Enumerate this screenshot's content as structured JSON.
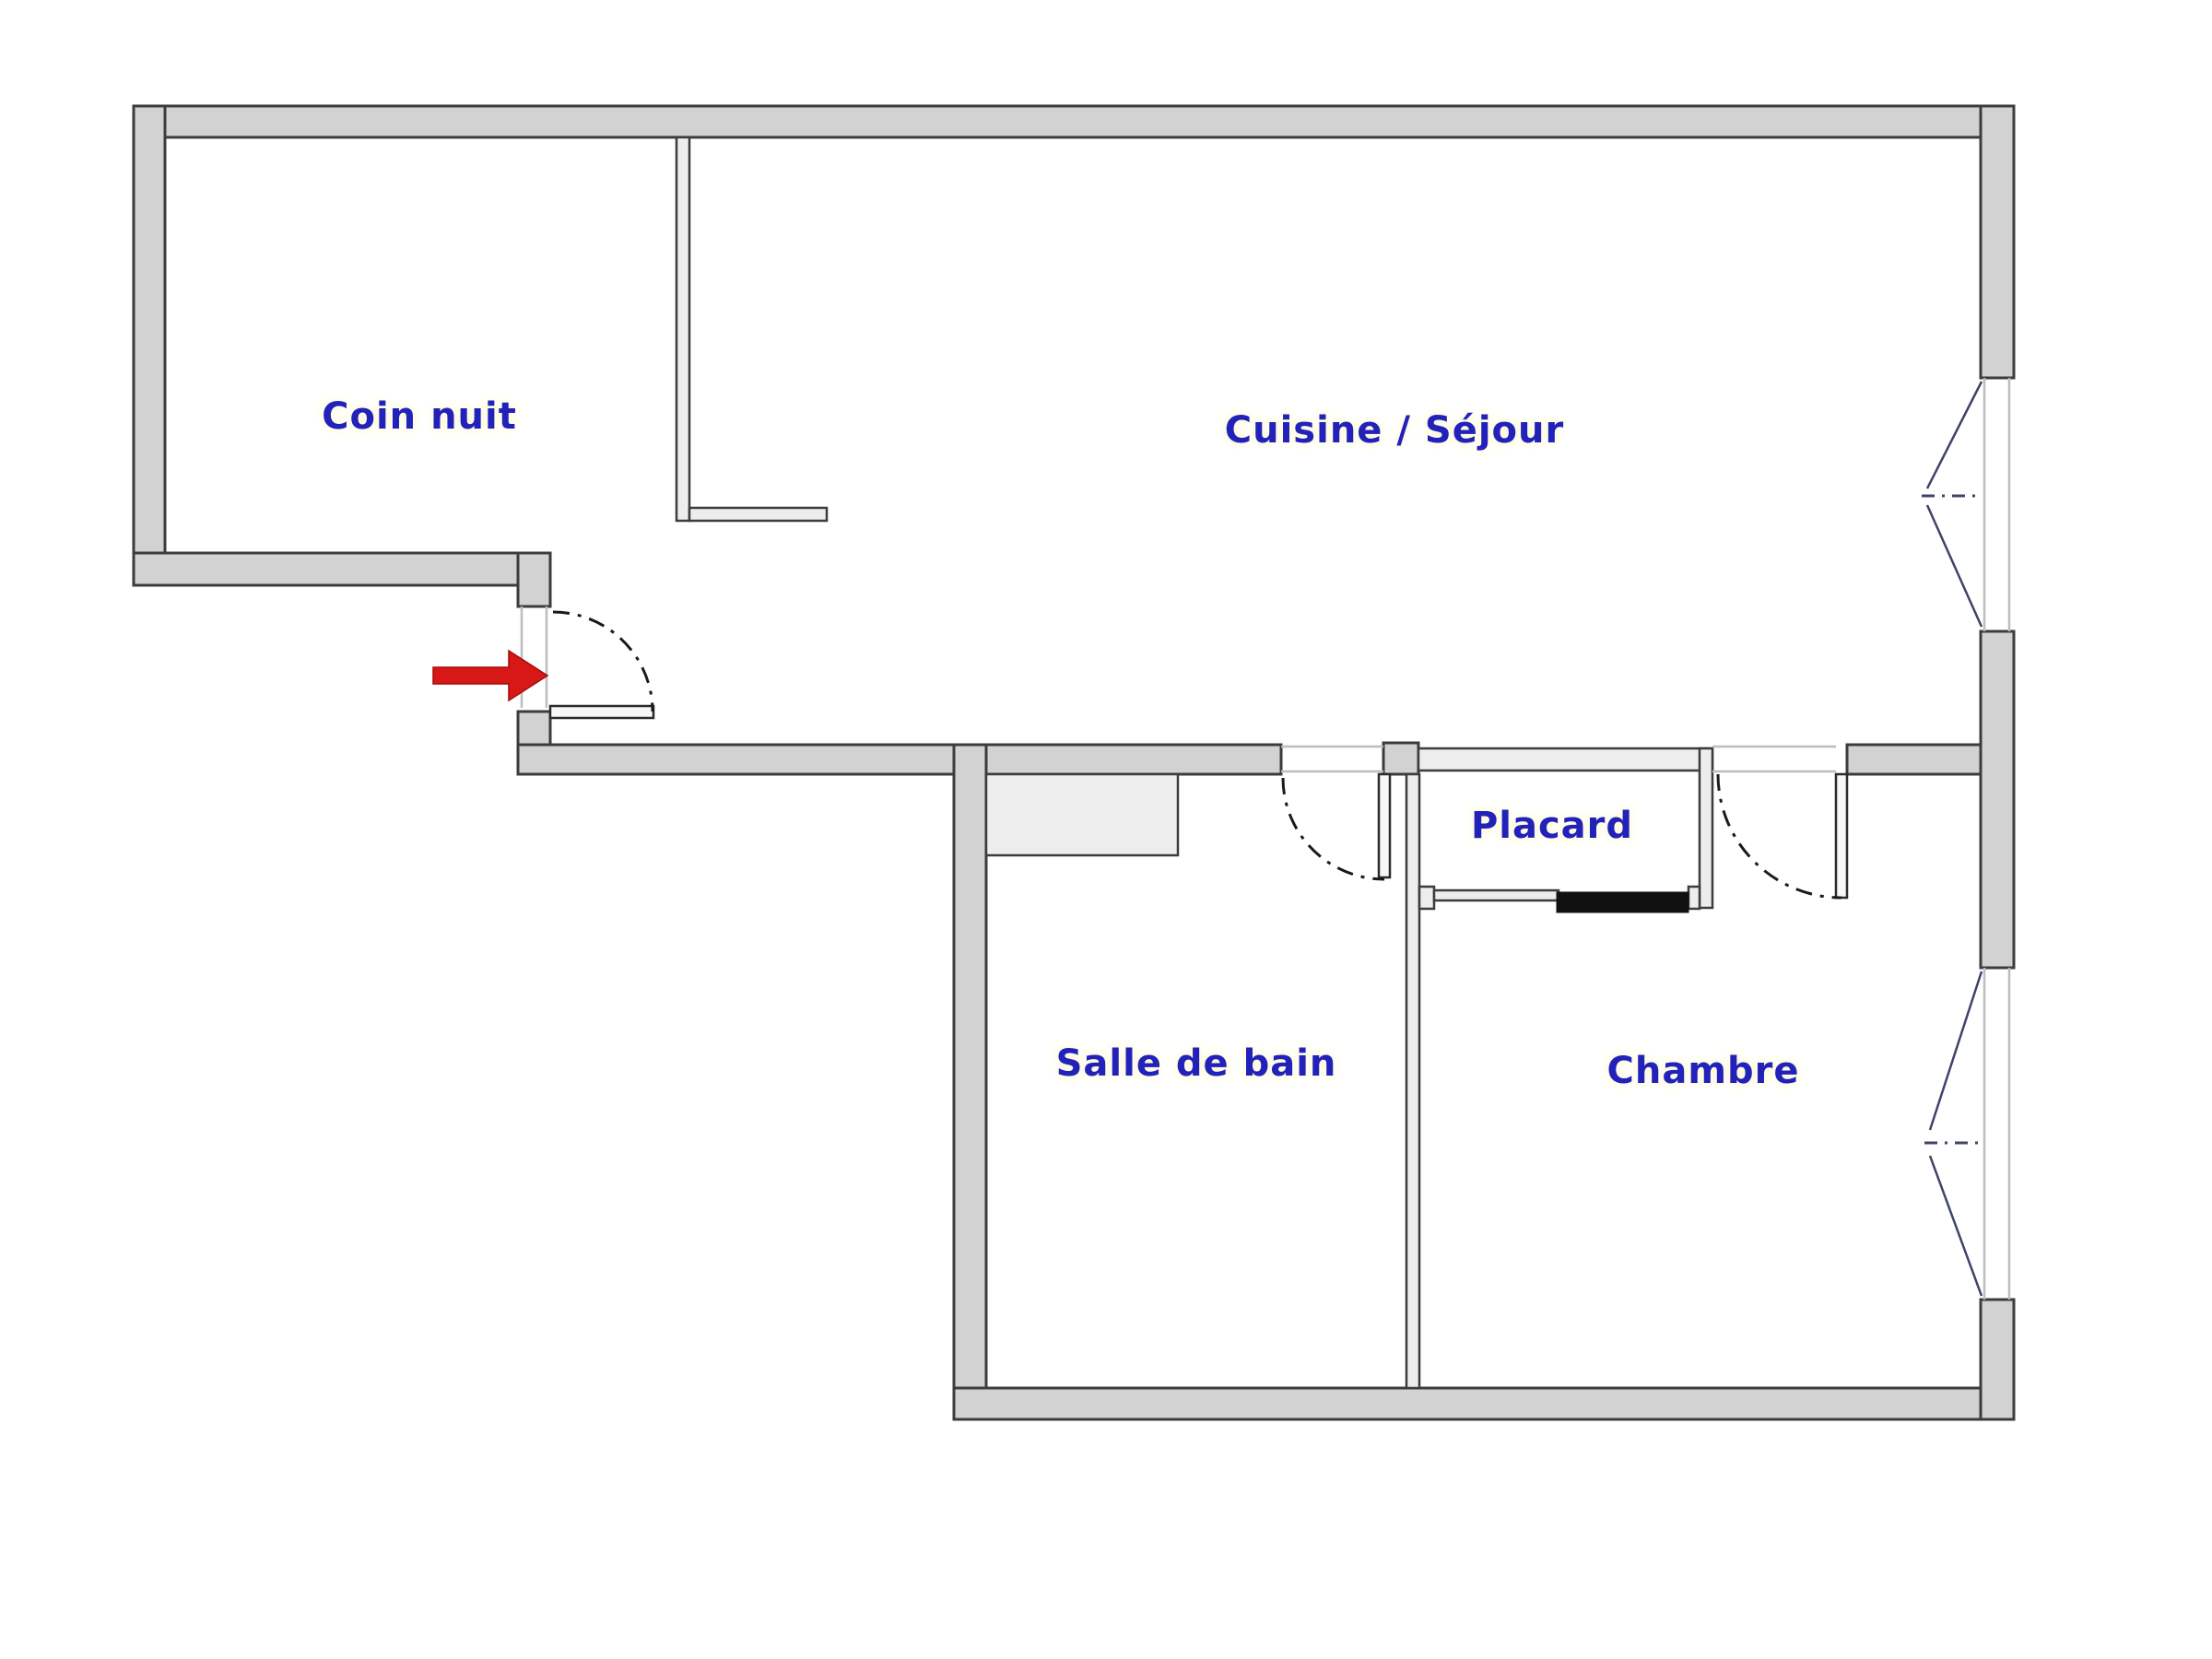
{
  "floor_plan": {
    "type": "apartment-floor-plan",
    "rooms": [
      {
        "id": "coin-nuit",
        "label": "Coin nuit"
      },
      {
        "id": "cuisine-sejour",
        "label": "Cuisine / Séjour"
      },
      {
        "id": "placard",
        "label": "Placard"
      },
      {
        "id": "salle-de-bain",
        "label": "Salle de bain"
      },
      {
        "id": "chambre",
        "label": "Chambre"
      }
    ],
    "features": {
      "entrance_arrow": "red arrow pointing right at entrance door",
      "doors": [
        "entrance swing door",
        "salle-de-bain swing door",
        "chambre swing door",
        "placard sliding door"
      ],
      "windows": [
        "right wall upper casement window",
        "right wall lower casement window"
      ]
    },
    "colors": {
      "wall_fill": "#d2d2d2",
      "wall_outline": "#3c3c3c",
      "label_color": "#2222bb",
      "window_glyph": "#3f4468",
      "door_arc": "#1a1a1a",
      "sliding_door": "#111111",
      "arrow_color": "#d81717"
    }
  }
}
